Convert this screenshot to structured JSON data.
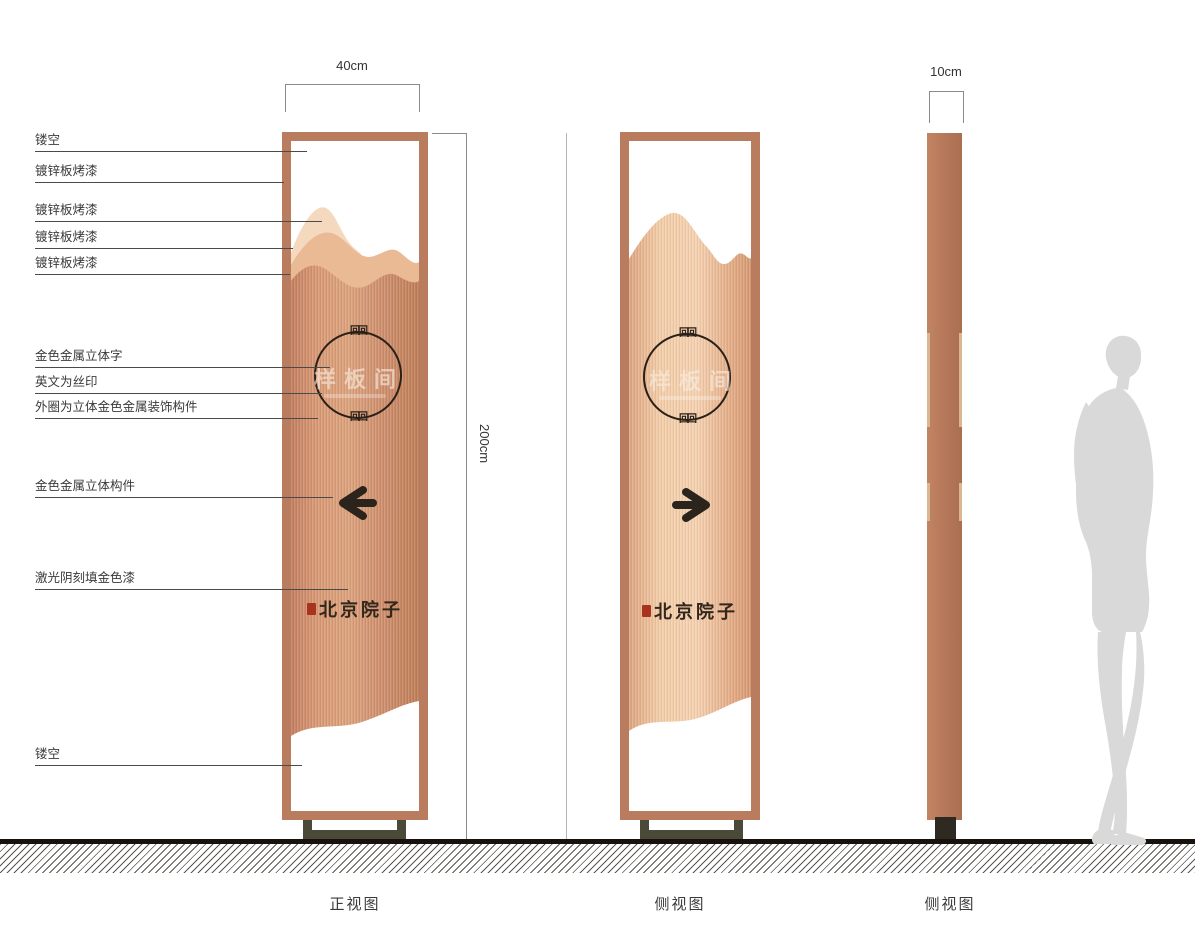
{
  "dimensions": {
    "width_label": "40cm",
    "height_label": "200cm",
    "depth_label": "10cm"
  },
  "callouts": [
    {
      "label": "镂空"
    },
    {
      "label": "镀锌板烤漆"
    },
    {
      "label": "镀锌板烤漆"
    },
    {
      "label": "镀锌板烤漆"
    },
    {
      "label": "镀锌板烤漆"
    },
    {
      "label": "金色金属立体字"
    },
    {
      "label": "英文为丝印"
    },
    {
      "label": "外圈为立体金色金属装饰构件"
    },
    {
      "label": "金色金属立体构件"
    },
    {
      "label": "激光阴刻填金色漆"
    },
    {
      "label": "镂空"
    }
  ],
  "sign": {
    "room_name": "样板间",
    "brand_name": "北京院子",
    "ornament_glyph": "回回"
  },
  "views": [
    {
      "caption": "正视图"
    },
    {
      "caption": "侧视图"
    },
    {
      "caption": "侧视图"
    }
  ],
  "icons": {
    "arrow_left": "arrow-left-icon",
    "arrow_right": "arrow-right-icon",
    "seal": "seal-stamp-icon",
    "silhouette": "person-silhouette"
  },
  "colors": {
    "frame_copper": "#b97c5e",
    "panel_copper": "#d29370",
    "mountain_light": "#f5d9bf",
    "mountain_mid": "#e9ba94",
    "side_panel_copper": "#b87a5b",
    "stand_olive": "#4b4a39",
    "seal_red": "#a8331f",
    "arrow_dark": "#2b241d",
    "silhouette_gray": "#d9d9d9"
  }
}
